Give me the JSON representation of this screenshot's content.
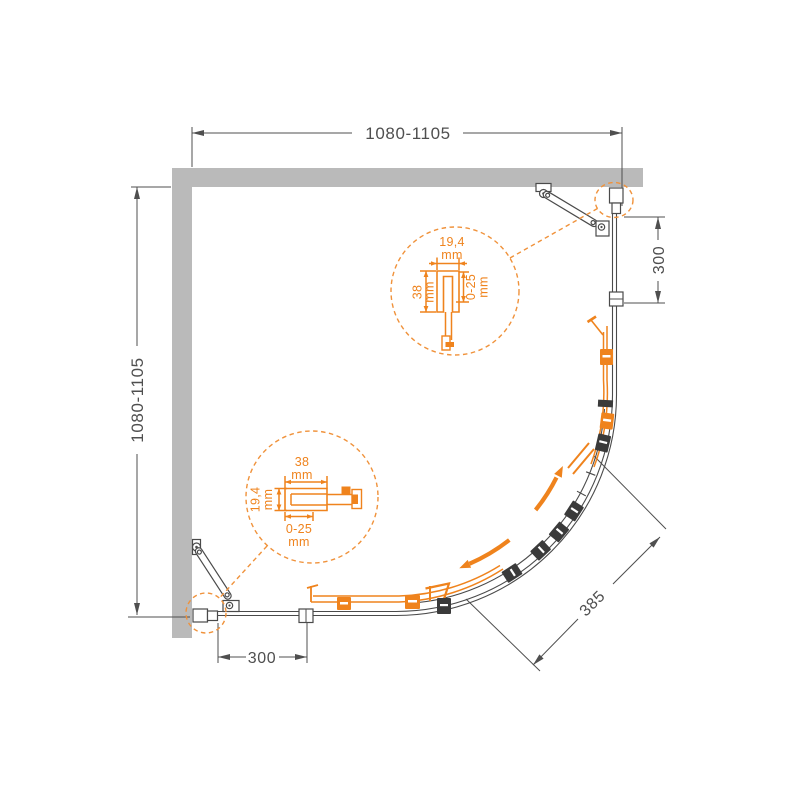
{
  "dims": {
    "top": "1080-1105",
    "left": "1080-1105",
    "right_panel": "300",
    "bottom_panel": "300",
    "diagonal": "385"
  },
  "detail_top": {
    "width": "19,4",
    "width_unit": "mm",
    "height": "38",
    "height_unit": "mm",
    "adjust": "0-25",
    "adjust_unit": "mm"
  },
  "detail_bottom": {
    "width": "38",
    "width_unit": "mm",
    "height": "19,4",
    "height_unit": "mm",
    "adjust": "0-25",
    "adjust_unit": "mm"
  },
  "colors": {
    "accent_orange": "#EF831D",
    "wall_gray": "#BABABA",
    "line_dark": "#4A4A4A"
  }
}
